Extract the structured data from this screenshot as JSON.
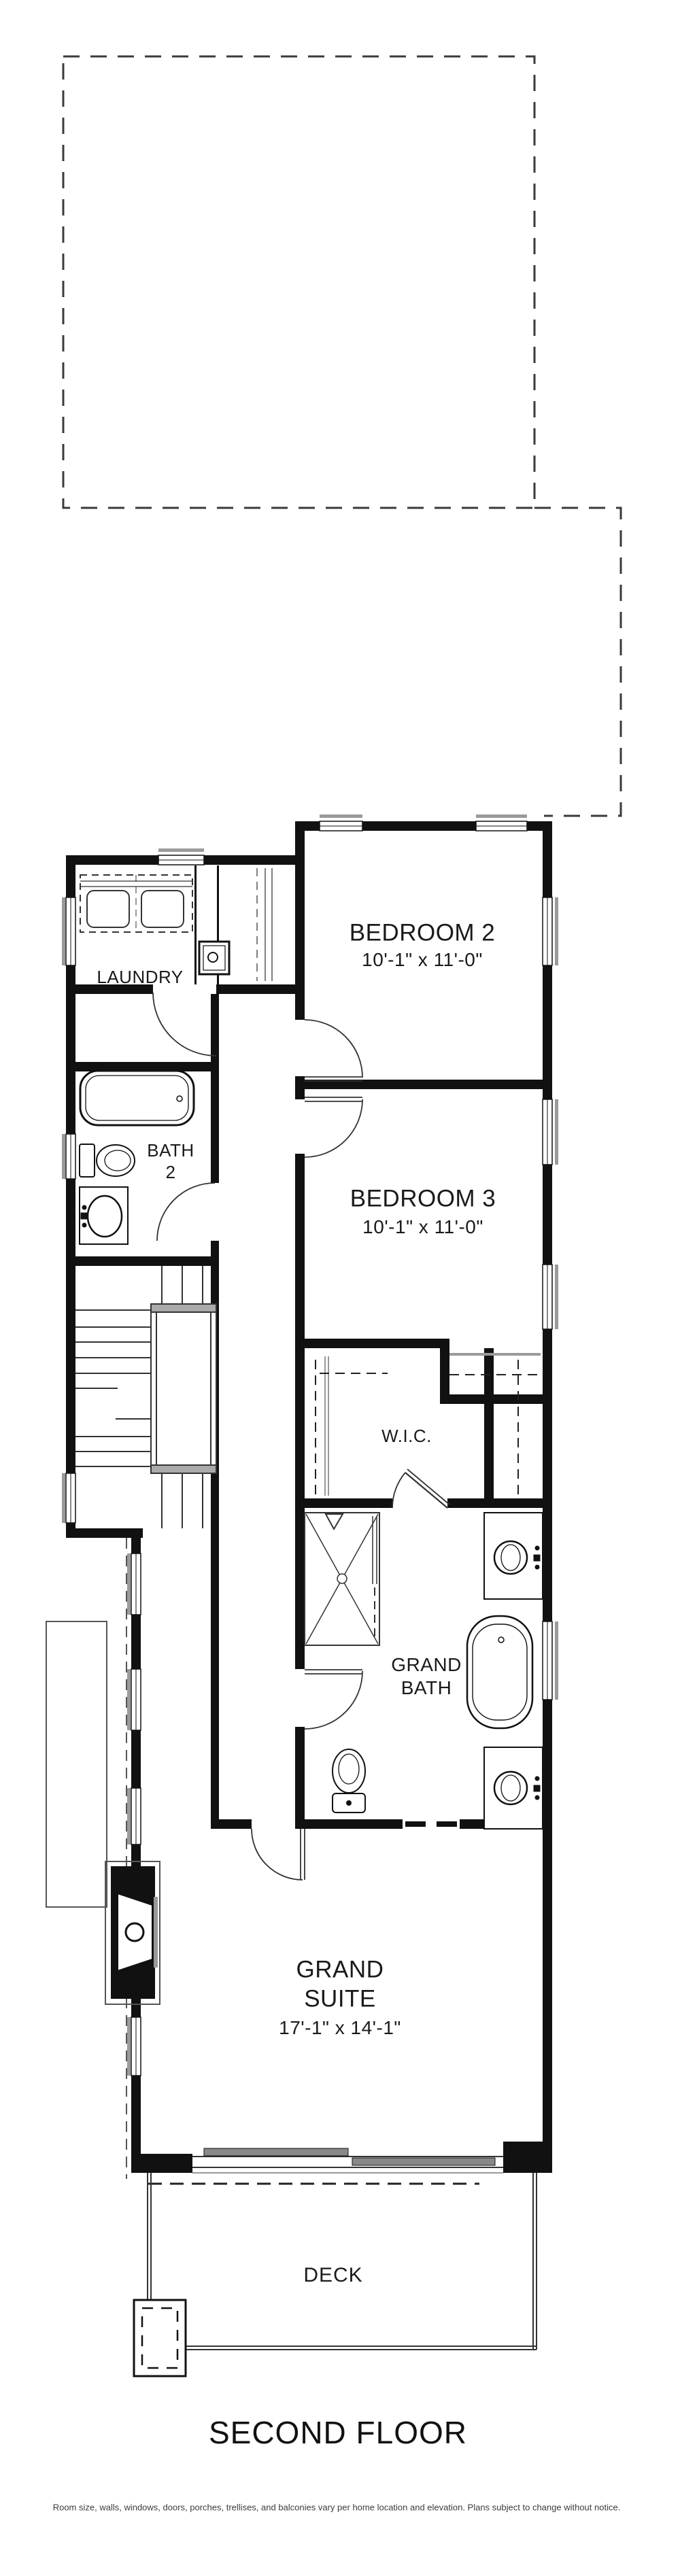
{
  "title": {
    "label": "SECOND FLOOR"
  },
  "disclaimer": "Room size, walls, windows, doors, porches, trellises, and balconies vary per home location and elevation. Plans subject to change without notice.",
  "rooms": {
    "laundry": {
      "name": "LAUNDRY"
    },
    "bedroom2": {
      "name": "BEDROOM 2",
      "dims": "10'-1\" x 11'-0\""
    },
    "bedroom3": {
      "name": "BEDROOM 3",
      "dims": "10'-1\" x 11'-0\""
    },
    "bath2": {
      "name_line1": "BATH",
      "name_line2": "2"
    },
    "wic": {
      "name": "W.I.C."
    },
    "grand_bath": {
      "name_line1": "GRAND",
      "name_line2": "BATH"
    },
    "grand_suite": {
      "name_line1": "GRAND",
      "name_line2": "SUITE",
      "dims": "17'-1\" x 14'-1\""
    },
    "deck": {
      "name": "DECK"
    }
  },
  "colors": {
    "wall": "#111111",
    "line": "#3a3a3a",
    "sill": "#9a9a9a",
    "text": "#1a1a1a"
  },
  "icons": {
    "roof_outline": "dashed-roof-outline",
    "fixtures": [
      "washer-dryer",
      "laundry-sink",
      "bathtub",
      "toilet",
      "vanity-sink",
      "shower",
      "freestanding-tub",
      "stairs",
      "fireplace",
      "deck-post"
    ]
  }
}
